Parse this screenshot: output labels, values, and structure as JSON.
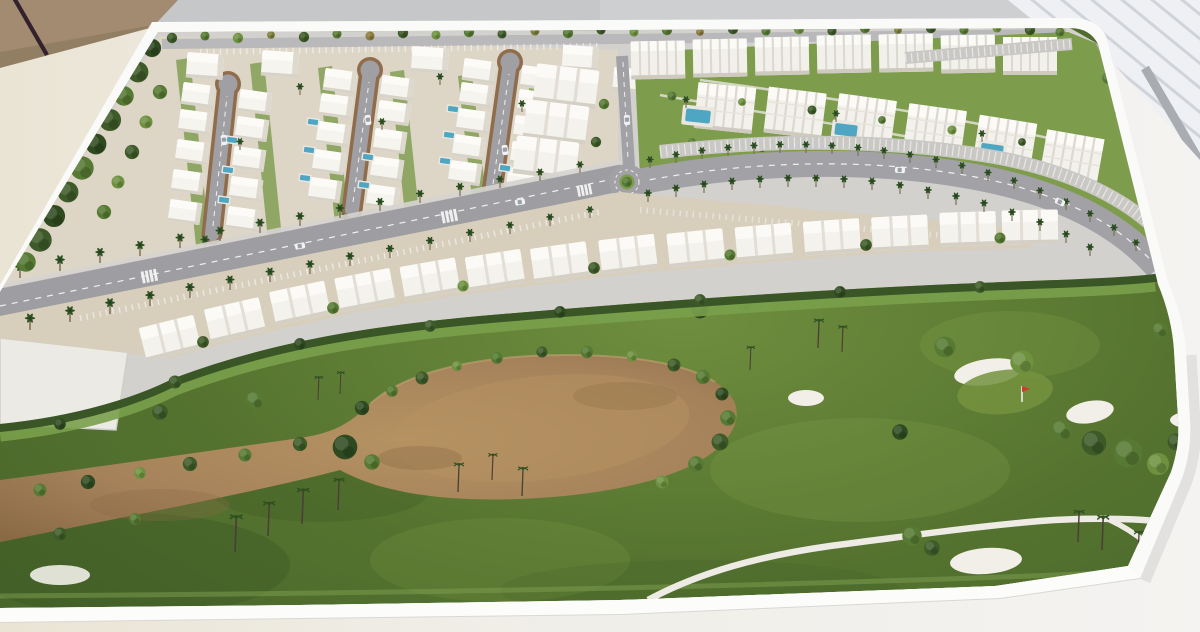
{
  "scene": {
    "description": "Photograph of a white architectural scale model on a table: a coastal golf-resort masterplan with a villa district (three cul-de-sac loop streets), an apartment district with pools, a palm-lined avenue and boulevard with a roundabout, a curved row of townhouses, and a large golf course with a sandy waste area, white bunkers, a red flag and white cart paths.",
    "objects": {
      "villas": 35,
      "loop_streets": 3,
      "apartment_blocks": 13,
      "terrace_blocks": 3,
      "townhouses": 14,
      "resort_pools": 3,
      "private_pools": 12,
      "sand_bunkers": 5,
      "golf_flags": 1,
      "roundabouts": 1,
      "cars": 8
    }
  },
  "palette": {
    "wall": "#c6c7c9",
    "wall_light": "#d6d7d9",
    "panel": "#eef0f3",
    "panel_stripe": "#c9ced4",
    "panel_edge": "#a9adb2",
    "cork": "#a28b70",
    "cork_dark": "#8f7a60",
    "stick": "#33222e",
    "table_left": "#eae4d4",
    "table_right": "#f4f3f1",
    "base_white": "#fafaf8",
    "fascia": "#fcfcfb",
    "fascia_edge": "#d9d8d5",
    "pavement": "#d3d1cd",
    "villa_ground": "#ddd5c6",
    "road": "#a2a1a5",
    "avenue": "#9e9da1",
    "kerb": "#8f6c4c",
    "marking": "#f2f2f2",
    "sidewalk": "#d6d4d0",
    "apron": "#d8cebc",
    "plot": "#eceae5",
    "lawn": "#7d9c4c",
    "hedge": "#3a5526",
    "hedge_grass": "#79a04b",
    "golf_light": "#6f8e3e",
    "golf_mid": "#55732f",
    "golf_dark": "#47642a",
    "sand": "#a5825a",
    "sand_light": "#b59262",
    "sand_dark": "#8a6a46",
    "bunker": "#f1efe8",
    "cart_path": "#edebe4",
    "pool_water": "#4fa6c2",
    "pool_deck": "#e9e7e0",
    "building": "#f4f2ec",
    "building_top": "#fbfaf7",
    "building_shade": "#d5d0c5",
    "flag_red": "#cf3a2c",
    "car_body": "#f2f2f2",
    "trunk": "#4a4036"
  }
}
